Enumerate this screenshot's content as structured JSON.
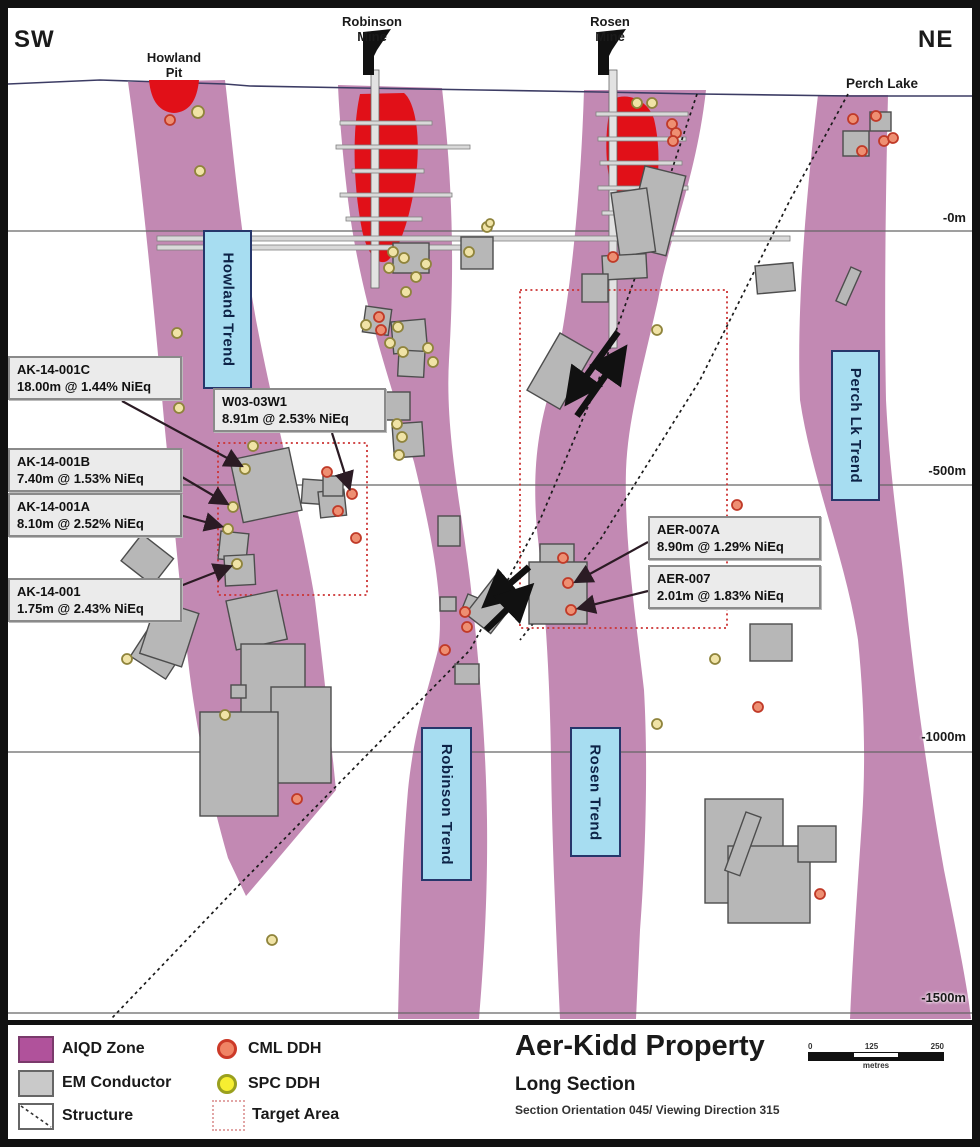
{
  "map": {
    "corner_left": "SW",
    "corner_right": "NE",
    "surface_features": {
      "howland_pit": {
        "lines": [
          "Howland",
          "Pit"
        ]
      },
      "robinson_mine": {
        "lines": [
          "Robinson",
          "Mine"
        ]
      },
      "rosen_mine": {
        "lines": [
          "Rosen",
          "Mine"
        ]
      },
      "perch_lake": "Perch Lake"
    },
    "trend_labels": [
      "Howland Trend",
      "Robinson Trend",
      "Rosen Trend",
      "Perch Lk Trend"
    ],
    "depth_markers": [
      "-0m",
      "-500m",
      "-1000m",
      "-1500m"
    ],
    "drill_annotations": [
      {
        "hole": "AK-14-001C",
        "intercept": "18.00m @ 1.44% NiEq"
      },
      {
        "hole": "W03-03W1",
        "intercept": "8.91m @ 2.53% NiEq"
      },
      {
        "hole": "AK-14-001B",
        "intercept": "7.40m @ 1.53% NiEq"
      },
      {
        "hole": "AK-14-001A",
        "intercept": "8.10m @ 2.52% NiEq"
      },
      {
        "hole": "AK-14-001",
        "intercept": "1.75m @ 2.43% NiEq"
      },
      {
        "hole": "AER-007A",
        "intercept": "8.90m @ 1.29% NiEq"
      },
      {
        "hole": "AER-007",
        "intercept": "2.01m @ 1.83% NiEq"
      }
    ]
  },
  "legend": {
    "aiqd": "AIQD Zone",
    "em": "EM Conductor",
    "structure": "Structure",
    "cml": "CML DDH",
    "spc": "SPC DDH",
    "target": "Target Area"
  },
  "title_block": {
    "title": "Aer-Kidd Property",
    "subtitle": "Long Section",
    "note": "Section Orientation 045/ Viewing Direction 315"
  },
  "scale_bar": {
    "ticks": [
      "0",
      "125",
      "250"
    ],
    "unit": "metres"
  },
  "colors": {
    "aiqd_zone": "#c289b3",
    "em_fill": "#b7b7b7",
    "em_edge": "#4d4d4d",
    "ore_red": "#e11018",
    "cml_fill": "#ee8f72",
    "cml_edge": "#c03a28",
    "spc_fill": "#f0e3a6",
    "spc_edge": "#8f843c",
    "target_edge": "#cc3333",
    "structure_line": "#1a1a1a",
    "surface_line": "#3c3c64",
    "gridline": "#666666",
    "level_fill": "#d9d9d9",
    "level_edge": "#808080",
    "arrow_dark": "#2b1b24"
  }
}
